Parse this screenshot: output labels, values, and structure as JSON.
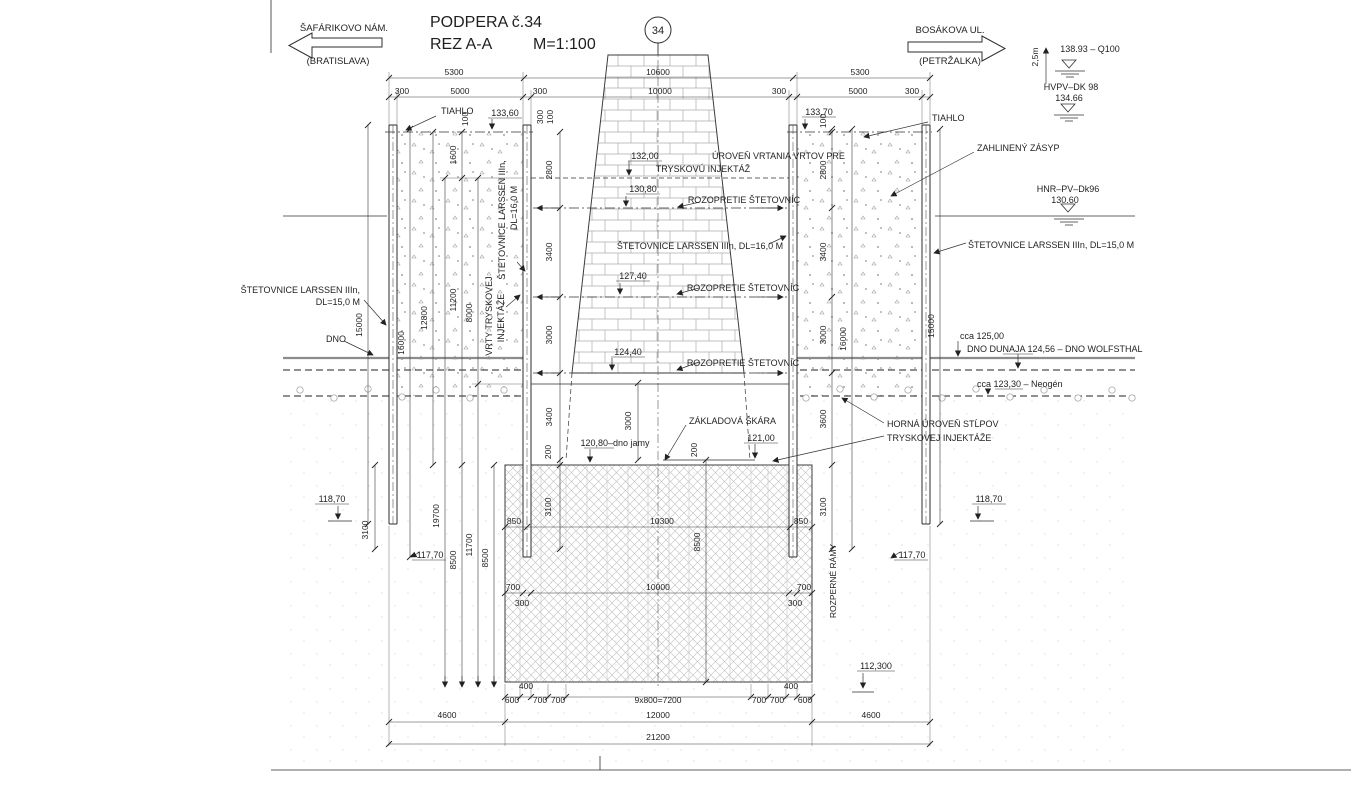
{
  "colors": {
    "ink": "#1f1f1f",
    "background": "#ffffff",
    "riverbed_gray": "#8c8c8c"
  },
  "title": {
    "name": "PODPERA č.34",
    "section": "REZ A-A",
    "scale": "M=1:100"
  },
  "marker": "34",
  "nav_left": {
    "name": "ŠAFÁRIKOVO NÁM.",
    "sub": "(BRATISLAVA)"
  },
  "nav_right": {
    "name": "BOSÁKOVA UL.",
    "sub": "(PETRŽALKA)"
  },
  "levels": {
    "q100_offset": "2,5m",
    "q100": "138.93 – Q100",
    "hvpv_name": "HVPV–DK 98",
    "hvpv_value": "134.66",
    "hnr_name": "HNR–PV–Dk96",
    "hnr_value": "130.60",
    "riverbed_cca": "cca 125,00",
    "dno_dunaja": "DNO DUNAJA 124,56 – DNO WOLFSTHAL",
    "neogen": "cca 123,30 – Neogén",
    "dno": "DNO"
  },
  "elevations": {
    "v13360": "133,60",
    "v13370": "133,70",
    "v13200": "132,00",
    "v13080": "130,80",
    "v12740": "127,40",
    "v12440": "124,40",
    "v12100": "121,00",
    "v12080": "120,80–dno jamy",
    "v11870": "118,70",
    "v11770": "117,70",
    "v112300": "112,300"
  },
  "notes": {
    "tiahlo": "TIAHLO",
    "drill1": "ÚROVEŇ VRTANIA VRTOV PRE",
    "drill2": "TRYSKOVÚ INJEKTÁŽ",
    "brace": "ROZOPRETIE ŠTETOVNÍC",
    "larssen15": "ŠTETOVNICE LARSSEN IIIn, DL=15,0 M",
    "larssen15a": "ŠTETOVNICE LARSSEN IIIn,",
    "larssen15b": "DL=15,0 M",
    "larssen16": "ŠTETOVNICE LARSSEN IIIn, DL=16,0 M",
    "larssen16a": "ŠTETOVNICE LARSSEN IIIn,",
    "larssen16b": "DL=16,0 M",
    "jet1": "VRTY TRYSKOVEJ",
    "jet2": "INJEKTÁŽE",
    "zasyp": "ZAHLINENÝ ZÁSYP",
    "zakladova": "ZÁKLADOVÁ ŠKÁRA",
    "horna1": "HORNÁ ÚROVEŇ STĹPOV",
    "horna2": "TRYSKOVEJ INJEKTÁŽE",
    "rozperne": "ROZPERNÉ RÁMY"
  },
  "dims": {
    "d100": "100",
    "d200": "200",
    "d300": "300",
    "d400": "400",
    "d600": "600",
    "d700": "700",
    "d850": "850",
    "d1600": "1600",
    "d2800": "2800",
    "d3000": "3000",
    "d3100": "3100",
    "d3400": "3400",
    "d3600": "3600",
    "d4600": "4600",
    "d5000": "5000",
    "d5300": "5300",
    "d8000": "8000",
    "d8500": "8500",
    "d9x800": "9x800=7200",
    "d10000": "10000",
    "d10300": "10300",
    "d10600": "10600",
    "d11200": "11200",
    "d11700": "11700",
    "d12000": "12000",
    "d12800": "12800",
    "d15000": "15000",
    "d16000": "16000",
    "d19700": "19700",
    "d21200": "21200"
  }
}
